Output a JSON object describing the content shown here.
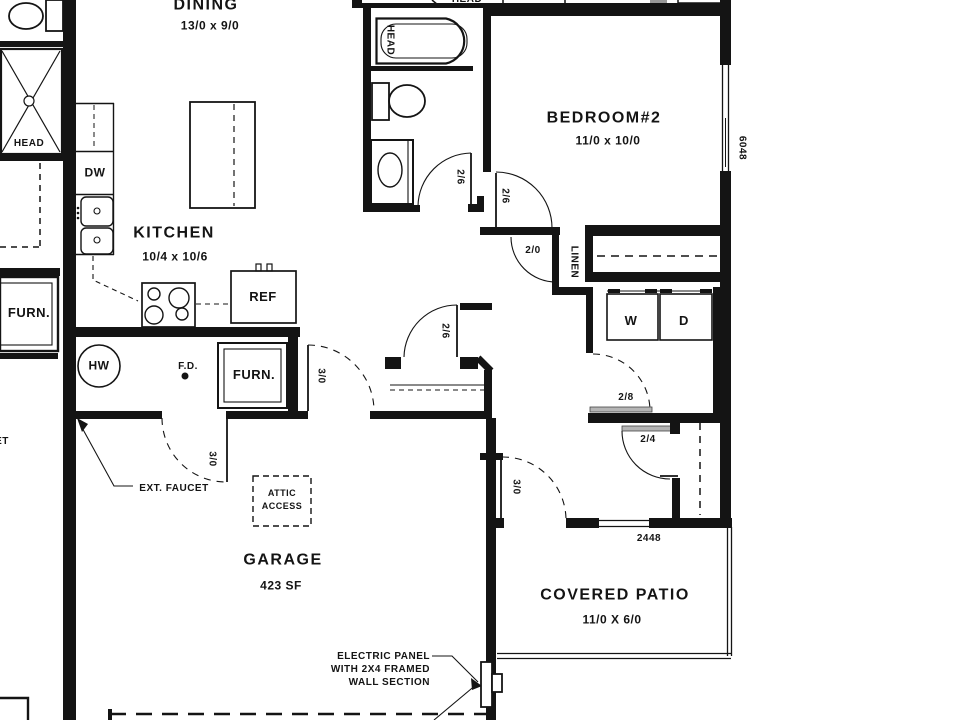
{
  "left_unit": {
    "head": "HEAD",
    "furnace": "FURN.",
    "cut_label": "ET"
  },
  "top_strip": {
    "head": "HEAD"
  },
  "dining": {
    "name": "DINING",
    "dims": "13/0 x 9/0"
  },
  "kitchen": {
    "name": "KITCHEN",
    "dims": "10/4 x 10/6",
    "dishwasher": "DW",
    "refrigerator": "REF"
  },
  "bath": {
    "tub_label": "HEAD"
  },
  "bedroom2": {
    "name": "BEDROOM#2",
    "dims": "11/0 x 10/0"
  },
  "closets": {
    "linen": "LINEN"
  },
  "laundry": {
    "washer": "W",
    "dryer": "D"
  },
  "utility": {
    "water_heater": "HW",
    "floor_drain": "F.D.",
    "furnace": "FURN."
  },
  "garage": {
    "name": "GARAGE",
    "area": "423 SF",
    "attic_access_line1": "ATTIC",
    "attic_access_line2": "ACCESS",
    "ext_faucet_note": "EXT. FAUCET"
  },
  "patio": {
    "name": "COVERED PATIO",
    "dims": "11/0 X 6/0"
  },
  "windows": {
    "bedroom_window": "6048",
    "rear_window": "2448"
  },
  "doors": {
    "bath": "2/6",
    "bedroom": "2/6",
    "hall": "2/6",
    "linen": "2/0",
    "laundry": "2/8",
    "closet": "2/4",
    "garage_side": "3/0",
    "garage_hall": "3/0",
    "patio": "3/0"
  },
  "annotations": {
    "electric_line1": "ELECTRIC PANEL",
    "electric_line2": "WITH 2X4 FRAMED",
    "electric_line3": "WALL SECTION"
  },
  "colors": {
    "line": "#141414",
    "background": "#ffffff",
    "header_fill": "#b5b5b5"
  }
}
